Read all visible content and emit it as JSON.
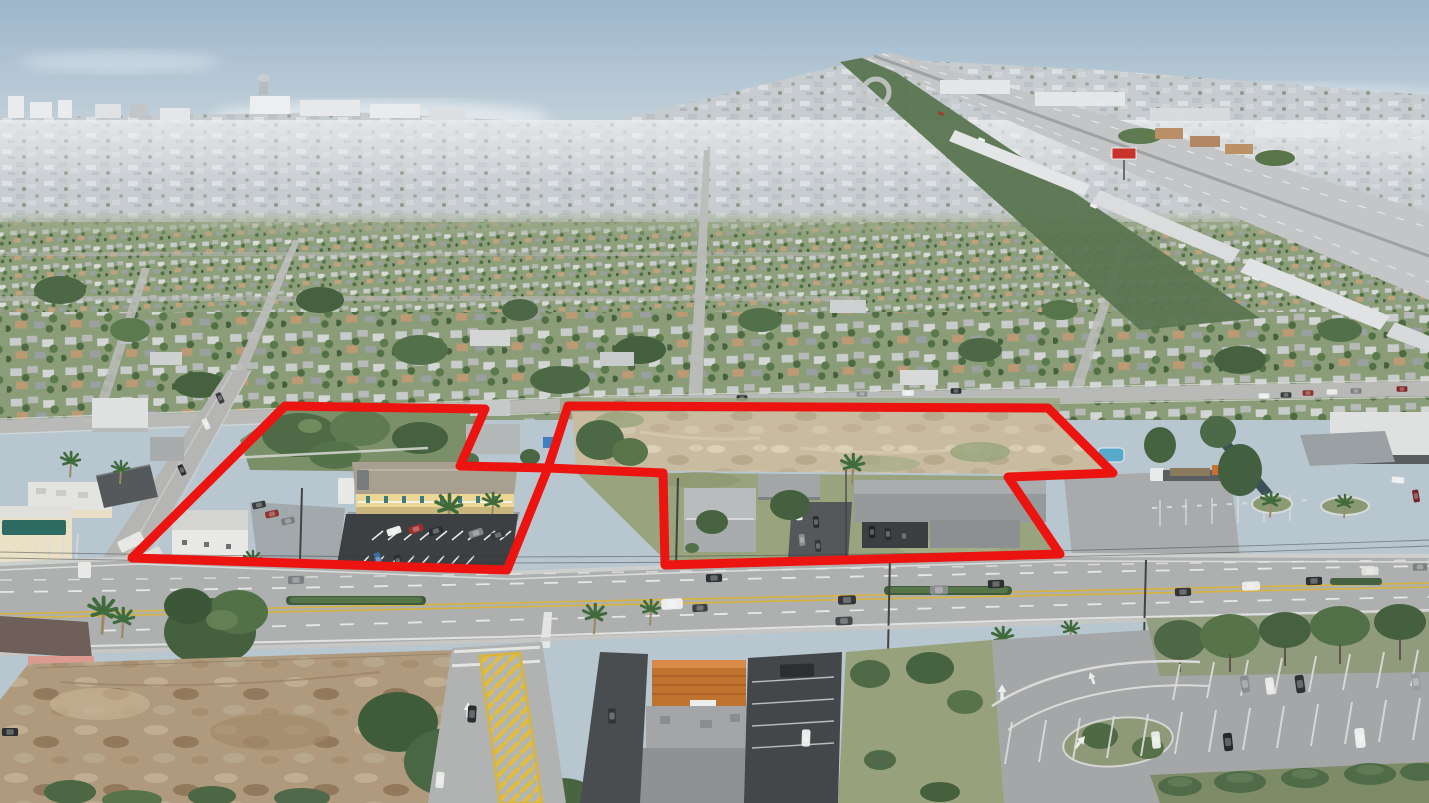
{
  "image": {
    "kind": "aerial-drone-photo",
    "subject": "oblique aerial of a suburban commercial corridor with two adjoining parcels outlined in red",
    "visible_text": ""
  },
  "overlay": {
    "outline_color": "#ec1410",
    "outline_width": 9,
    "parcel_a_points": "285,406 485,409 460,466 548,468 507,570 132,558",
    "parcel_b_points": "568,406 1048,408 1113,473 1008,477 1060,554 665,565 663,473 548,468"
  },
  "palette": {
    "sky_top": "#9db7cc",
    "sky_horizon": "#d9dfe2",
    "distant_city": "#c6cbcf",
    "suburb_green": "#8ea07b",
    "tree_dark": "#4c6845",
    "sand_lot": "#c9bba0",
    "dirt_lot": "#b09a7e",
    "arterial_asphalt": "#aeb0af",
    "fresh_asphalt": "#3d4043",
    "yellow_building": "#ecd794",
    "orange_tile_roof": "#c0722f",
    "teal_awning": "#2e6b62",
    "lane_yellow": "#d9b43c",
    "billboard_red": "#c8332b",
    "pool_blue": "#57aacb",
    "outline_red": "#ec1410"
  },
  "landmarks": {
    "highway": "multi-lane highway receding to horizon, upper right",
    "main_road": "wide arterial road across the foreground",
    "vacant_lot": "cleared sandy land inside right parcel",
    "apartment_building": "two-story yellow building with parking inside left parcel",
    "billboard": "red billboard beside the highway",
    "striped_median": "yellow hatched median on the side street, bottom center-left"
  }
}
